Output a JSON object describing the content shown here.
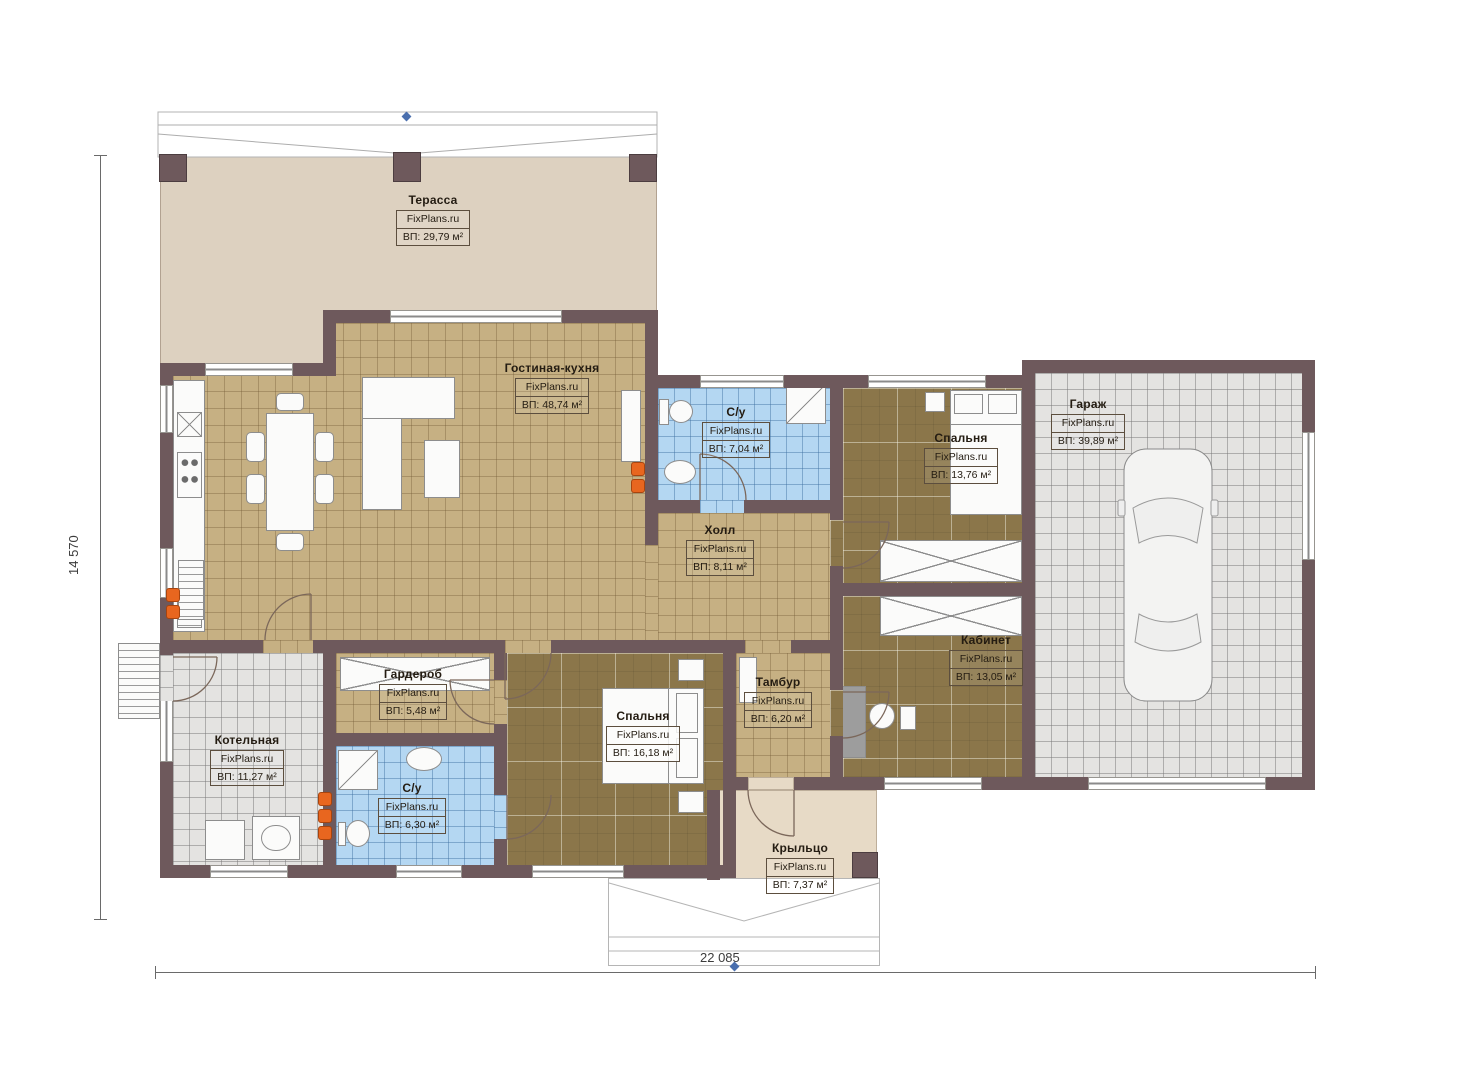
{
  "plan": {
    "brand": "FixPlans.ru",
    "rooms": [
      {
        "id": "terrace",
        "name": "Терасса",
        "area": "ВП: 29,79 м²"
      },
      {
        "id": "living",
        "name": "Гостиная-кухня",
        "area": "ВП: 48,74 м²"
      },
      {
        "id": "bath1",
        "name": "С/у",
        "area": "ВП: 7,04 м²"
      },
      {
        "id": "bedroom1",
        "name": "Спальня",
        "area": "ВП: 13,76 м²"
      },
      {
        "id": "garage",
        "name": "Гараж",
        "area": "ВП: 39,89 м²"
      },
      {
        "id": "hall",
        "name": "Холл",
        "area": "ВП: 8,11 м²"
      },
      {
        "id": "wardrobe",
        "name": "Гардероб",
        "area": "ВП: 5,48 м²"
      },
      {
        "id": "bedroom2",
        "name": "Спальня",
        "area": "ВП: 16,18 м²"
      },
      {
        "id": "tambour",
        "name": "Тамбур",
        "area": "ВП: 6,20 м²"
      },
      {
        "id": "office",
        "name": "Кабинет",
        "area": "ВП: 13,05 м²"
      },
      {
        "id": "boiler",
        "name": "Котельная",
        "area": "ВП: 11,27 м²"
      },
      {
        "id": "bath2",
        "name": "С/у",
        "area": "ВП: 6,30 м²"
      },
      {
        "id": "porch",
        "name": "Крыльцо",
        "area": "ВП: 7,37 м²"
      }
    ],
    "dimensions": {
      "height": "14 570",
      "width": "22 085"
    }
  },
  "colors": {
    "wall": "#6e595c",
    "floor_terrace": "#ddd1c0",
    "floor_porch": "#e7dac6",
    "tile_tan": "#c6b083",
    "tile_blue": "#b4d7f2",
    "tile_gray": "#e4e3e1",
    "tile_dark": "#8b764a",
    "radiator": "#e8661f",
    "grip": "#4a6fae",
    "text": "#241c12"
  }
}
